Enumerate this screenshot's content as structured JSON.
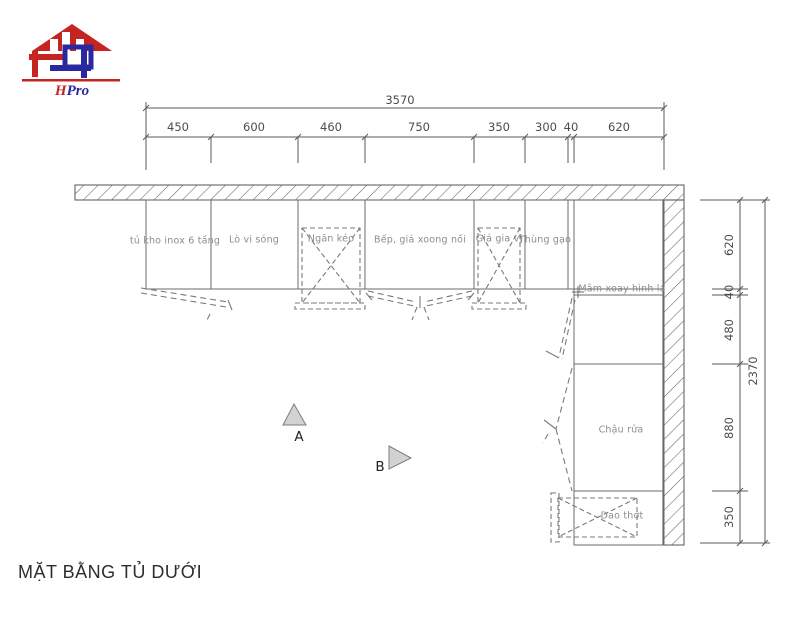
{
  "logo": {
    "brand_h": "H",
    "brand_rest": "Pro"
  },
  "title": "MẶT BẰNG TỦ DƯỚI",
  "dims": {
    "top_total": "3570",
    "top_segments": [
      "450",
      "600",
      "460",
      "750",
      "350",
      "300",
      "40",
      "620"
    ],
    "right_total": "2370",
    "right_segments": [
      "620",
      "40",
      "480",
      "880",
      "350"
    ]
  },
  "cabinets": [
    {
      "label": "tủ kho inox 6 tầng"
    },
    {
      "label": "Lò vi sóng"
    },
    {
      "label": "Ngăn kéo"
    },
    {
      "label": "Bếp, giá xoong nồi"
    },
    {
      "label": "Giá gia vị"
    },
    {
      "label": "Thùng gạo"
    },
    {
      "label": "Mâm xoay hình lá"
    },
    {
      "label": "Chậu rửa"
    },
    {
      "label": "Dao thớt"
    }
  ],
  "markers": [
    {
      "label": "A"
    },
    {
      "label": "B"
    }
  ],
  "colors": {
    "logo_red": "#c62420",
    "logo_blue": "#2a28a0",
    "drawing_line": "#6b6b6b",
    "dashed_line": "#7a7a7a",
    "label_text": "#8d8d8d",
    "dim_text": "#4c4c4c",
    "marker_fill": "#d2d2d2"
  }
}
